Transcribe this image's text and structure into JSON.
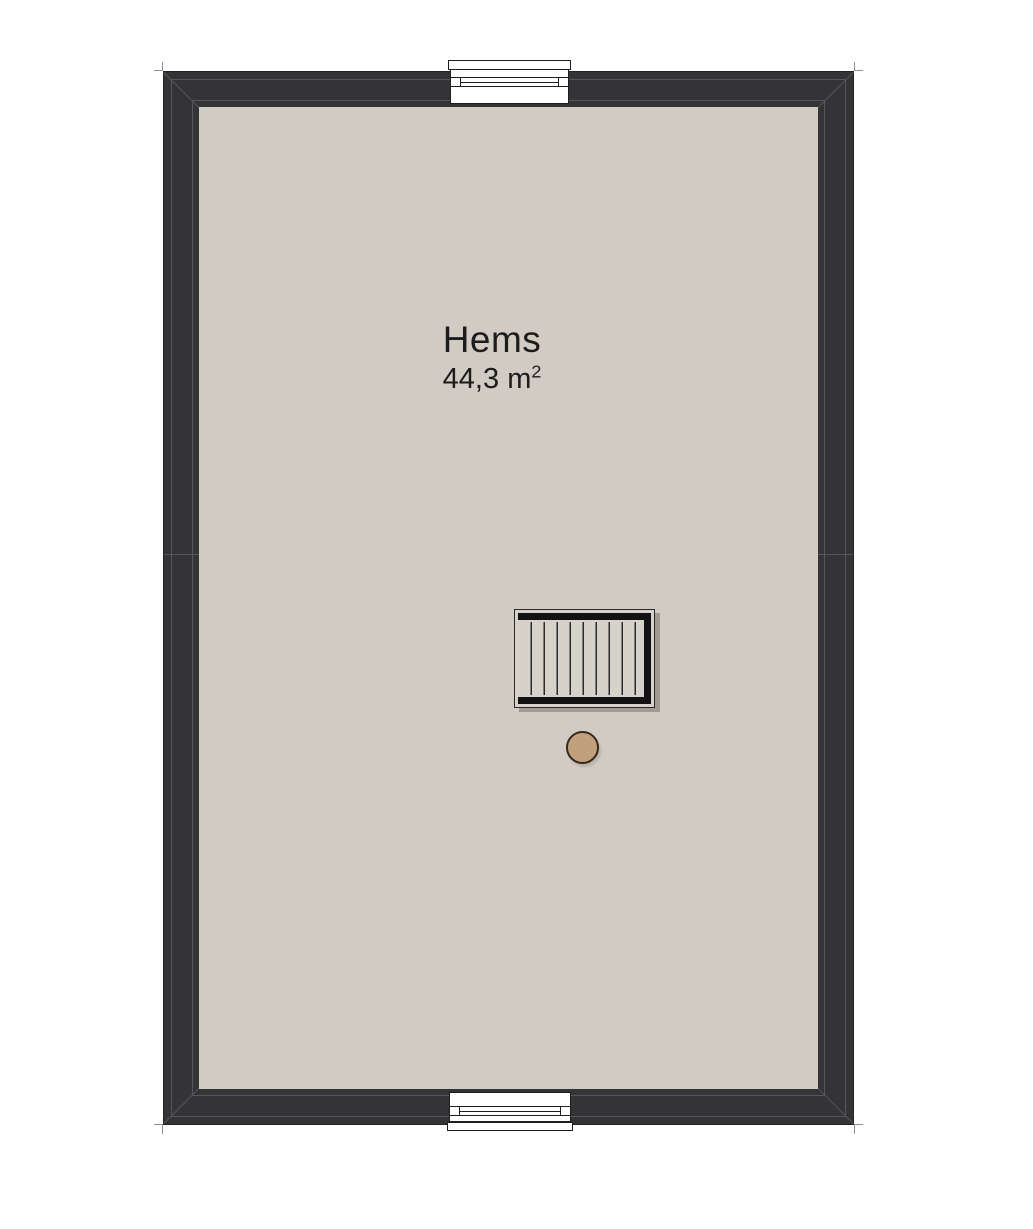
{
  "room": {
    "name": "Hems",
    "area_value": "44,3",
    "area_unit": "m",
    "area_exponent": "2"
  },
  "elements": {
    "staircase": "staircase-to-lower-floor",
    "column": "support-column",
    "window_top": "window-opening-top-wall",
    "window_bottom": "window-opening-bottom-wall"
  },
  "colors": {
    "outside": "#ffffff",
    "wall": "#343436",
    "wall_edge": "#232325",
    "wall_line": "#56565c",
    "corner_tick": "#8f8f8f",
    "floor": "#d2cbc3",
    "stair_bg": "#d6d2c9",
    "stair_bar": "#121212",
    "stair_tread": "#2a2a2a",
    "window_fill": "#ffffff",
    "window_edge": "#1d1d1d",
    "column_fill": "#c2a07e",
    "column_stroke": "#36281a",
    "text": "#1c1c1c"
  }
}
